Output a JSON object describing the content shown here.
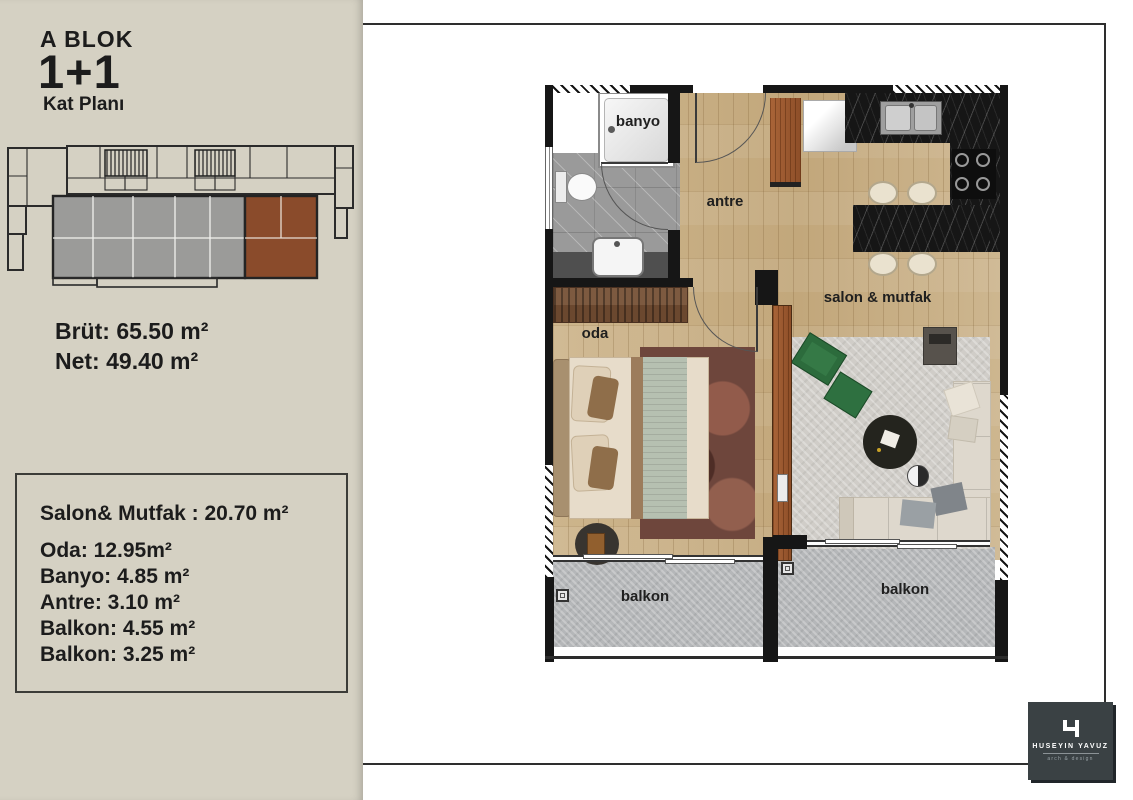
{
  "sidebar": {
    "block_title": "A BLOK",
    "unit_type": "1+1",
    "plan_label": "Kat Planı",
    "gross_area": "Brüt: 65.50 m²",
    "net_area": "Net: 49.40 m²",
    "area_items": [
      "Salon& Mutfak : 20.70 m²",
      "Oda: 12.95m²",
      "Banyo: 4.85 m²",
      "Antre: 3.10 m²",
      "Balkon: 4.55 m²",
      "Balkon: 3.25 m²"
    ]
  },
  "plan": {
    "labels": {
      "bathroom": "banyo",
      "hall": "antre",
      "bedroom": "oda",
      "living_kitchen": "salon & mutfak",
      "balcony_left": "balkon",
      "balcony_right": "balkon"
    }
  },
  "logo": {
    "name": "HUSEYIN YAVUZ",
    "tagline": "arch & design"
  },
  "colors": {
    "sidebar_bg": "#d5d1c3",
    "highlight_unit": "#8a4b2b",
    "muted_units": "#9b9b99",
    "wood_floor": "#c8b087",
    "tile": "#9a9a9a",
    "balcony": "#b5b7b9",
    "counter": "#161616",
    "logo_bg": "#3a4144"
  }
}
